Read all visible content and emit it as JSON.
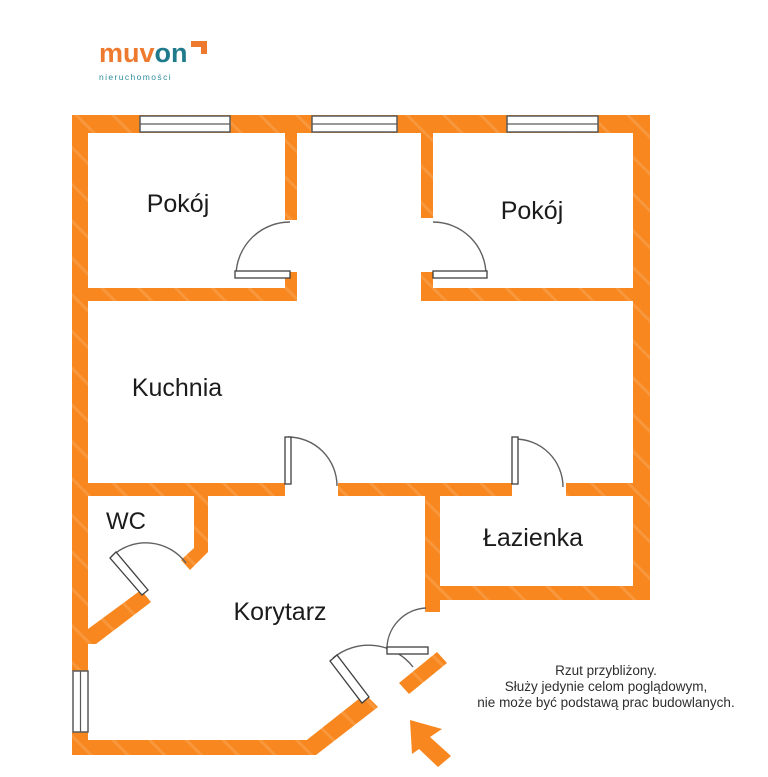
{
  "page": {
    "width": 768,
    "height": 777,
    "background": "#ffffff"
  },
  "logo": {
    "brand_orange": "muv",
    "brand_teal": "on",
    "subtitle": "nieruchomości",
    "colors": {
      "orange": "#EE7A2F",
      "teal": "#1F7A8C",
      "subtitle": "#2E8C9C"
    }
  },
  "floor_plan": {
    "wall_color": "#F7871E",
    "wall_streak_color": "#FA9B43",
    "label_color": "#1B1B1B",
    "rooms": [
      {
        "id": "pokoj-left",
        "label": "Pokój"
      },
      {
        "id": "pokoj-right",
        "label": "Pokój"
      },
      {
        "id": "kuchnia",
        "label": "Kuchnia"
      },
      {
        "id": "wc",
        "label": "WC"
      },
      {
        "id": "lazienka",
        "label": "Łazienka"
      },
      {
        "id": "korytarz",
        "label": "Korytarz"
      }
    ]
  },
  "disclaimer": {
    "line1": "Rzut przybliżony.",
    "line2": "Służy jedynie celom poglądowym,",
    "line3": "nie może być podstawą prac budowlanych."
  }
}
